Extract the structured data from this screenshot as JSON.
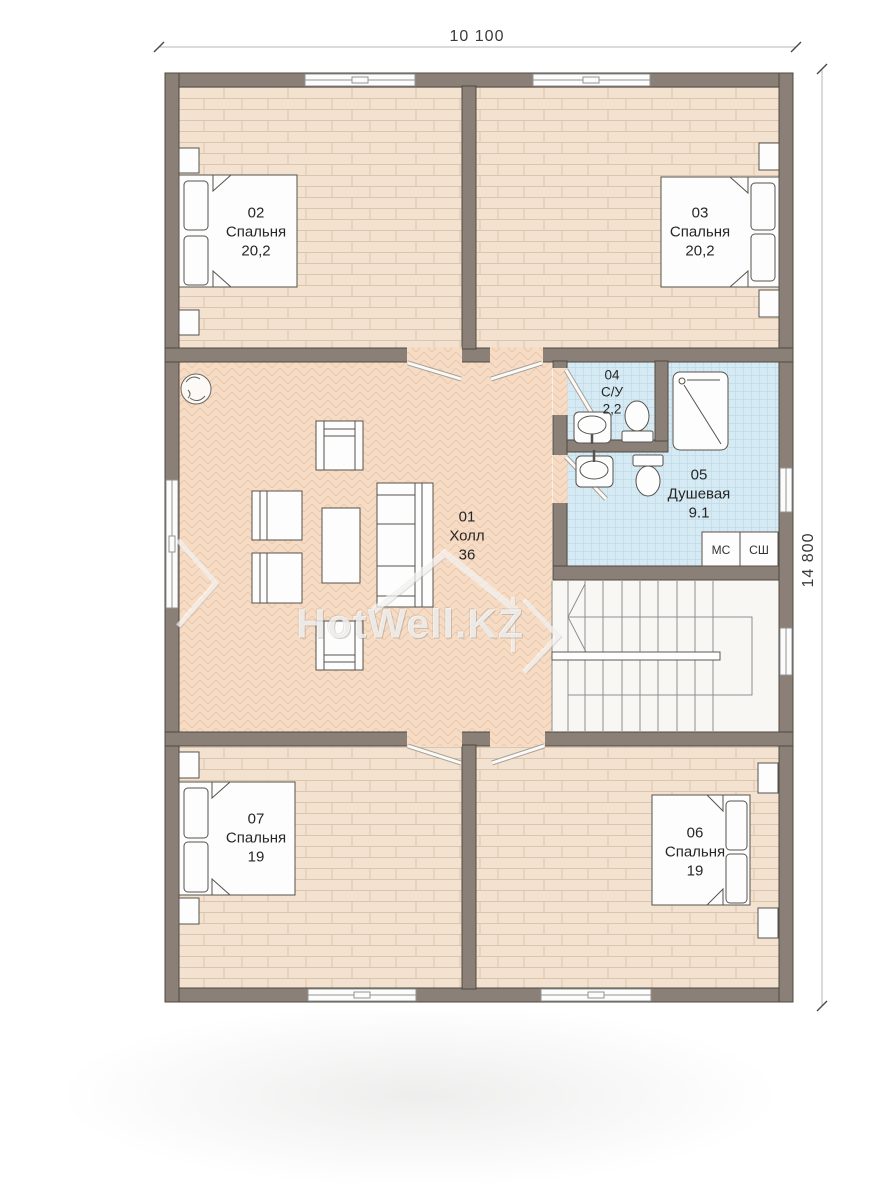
{
  "plan": {
    "dimensions": {
      "width_label": "10 100",
      "height_label": "14 800"
    },
    "rooms": [
      {
        "number": "01",
        "name": "Холл",
        "area": "36"
      },
      {
        "number": "02",
        "name": "Спальня",
        "area": "20,2"
      },
      {
        "number": "03",
        "name": "Спальня",
        "area": "20,2"
      },
      {
        "number": "04",
        "name": "С/У",
        "area": "2,2"
      },
      {
        "number": "05",
        "name": "Душевая",
        "area": "9.1"
      },
      {
        "number": "06",
        "name": "Спальня",
        "area": "19"
      },
      {
        "number": "07",
        "name": "Спальня",
        "area": "19"
      }
    ],
    "closets": [
      {
        "label": "МС"
      },
      {
        "label": "СШ"
      }
    ],
    "watermark": {
      "text": "HotWell.KZ"
    },
    "colors": {
      "wall": "#8b8078",
      "wall_edge": "#4f4941",
      "wood_floor": "#f3e2cf",
      "hall_floor": "#f7dcc5",
      "tile_floor": "#d6eaf3",
      "label_text": "#262626"
    }
  }
}
